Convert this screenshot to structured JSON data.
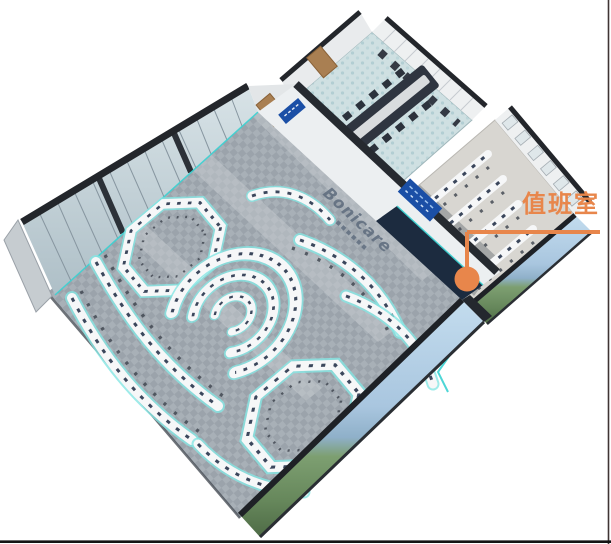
{
  "annotation": {
    "label": "值班室",
    "color": "#e8864b"
  },
  "branding": {
    "wall_logo": "Bonicare",
    "logo_color": "#5d6b7d"
  },
  "rooms": {
    "duty_room": {
      "label": "值班室"
    }
  },
  "colors": {
    "accent_orange": "#e8864b",
    "console_glow_cyan": "#86e6e4",
    "console_white": "#f6f7f8",
    "equipment_navy": "#27334a",
    "main_floor_gray": "#9ba3ab",
    "meeting_carpet_teal": "#cfe0e2",
    "duty_floor_beige": "#d8d6d1",
    "video_wall_navy": "#1c2b3f",
    "sign_blue": "#1b4fa6",
    "landscape_sky": "#aac7e0",
    "landscape_land": "#66875b",
    "border_right": "#3f3434",
    "border_bottom": "#141414"
  }
}
